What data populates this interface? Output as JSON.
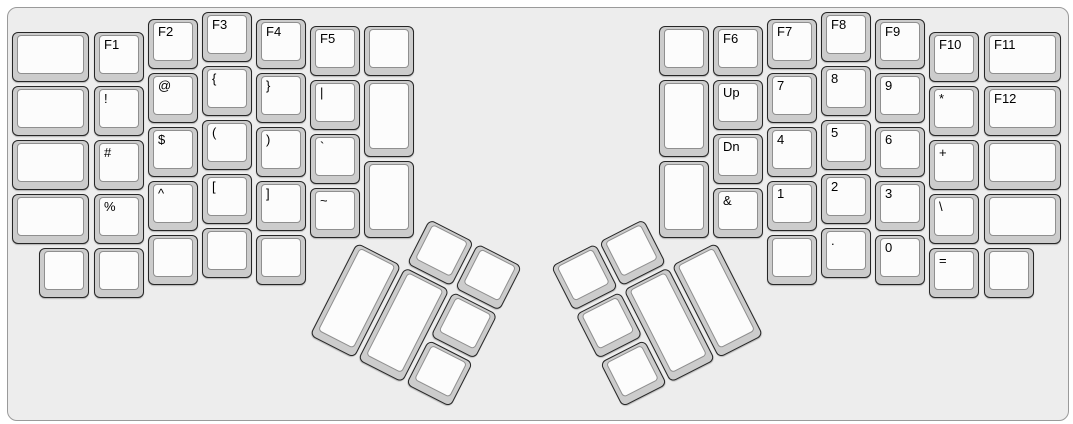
{
  "board": {
    "bg_color": "#ededed",
    "border_color": "#9a9a9a",
    "key_base_color": "#cccccc",
    "key_border_color": "#262626",
    "key_top_color": "#fcfcfc",
    "key_top_border_color": "#8f8f8f",
    "label_color": "#000000"
  },
  "unit_px": 54,
  "main_keys": [
    {
      "label": "",
      "x": 10,
      "y": 30,
      "w": 81,
      "h": 54
    },
    {
      "label": "",
      "x": 10,
      "y": 84,
      "w": 81,
      "h": 54
    },
    {
      "label": "",
      "x": 10,
      "y": 138,
      "w": 81,
      "h": 54
    },
    {
      "label": "",
      "x": 10,
      "y": 192,
      "w": 81,
      "h": 54
    },
    {
      "label": "F1",
      "x": 92,
      "y": 30,
      "w": 54,
      "h": 54
    },
    {
      "label": "!",
      "x": 92,
      "y": 84,
      "w": 54,
      "h": 54
    },
    {
      "label": "#",
      "x": 92,
      "y": 138,
      "w": 54,
      "h": 54
    },
    {
      "label": "%",
      "x": 92,
      "y": 192,
      "w": 54,
      "h": 54
    },
    {
      "label": "F2",
      "x": 146,
      "y": 17,
      "w": 54,
      "h": 54
    },
    {
      "label": "@",
      "x": 146,
      "y": 71,
      "w": 54,
      "h": 54
    },
    {
      "label": "$",
      "x": 146,
      "y": 125,
      "w": 54,
      "h": 54
    },
    {
      "label": "^",
      "x": 146,
      "y": 179,
      "w": 54,
      "h": 54
    },
    {
      "label": "F3",
      "x": 200,
      "y": 10,
      "w": 54,
      "h": 54
    },
    {
      "label": "{",
      "x": 200,
      "y": 64,
      "w": 54,
      "h": 54
    },
    {
      "label": "(",
      "x": 200,
      "y": 118,
      "w": 54,
      "h": 54
    },
    {
      "label": "[",
      "x": 200,
      "y": 172,
      "w": 54,
      "h": 54
    },
    {
      "label": "F4",
      "x": 254,
      "y": 17,
      "w": 54,
      "h": 54
    },
    {
      "label": "}",
      "x": 254,
      "y": 71,
      "w": 54,
      "h": 54
    },
    {
      "label": ")",
      "x": 254,
      "y": 125,
      "w": 54,
      "h": 54
    },
    {
      "label": "]",
      "x": 254,
      "y": 179,
      "w": 54,
      "h": 54
    },
    {
      "label": "F5",
      "x": 308,
      "y": 24,
      "w": 54,
      "h": 54
    },
    {
      "label": "|",
      "x": 308,
      "y": 78,
      "w": 54,
      "h": 54
    },
    {
      "label": "`",
      "x": 308,
      "y": 132,
      "w": 54,
      "h": 54
    },
    {
      "label": "~",
      "x": 308,
      "y": 186,
      "w": 54,
      "h": 54
    },
    {
      "label": "",
      "x": 362,
      "y": 24,
      "w": 54,
      "h": 54
    },
    {
      "label": "",
      "x": 362,
      "y": 78,
      "w": 54,
      "h": 81
    },
    {
      "label": "",
      "x": 362,
      "y": 159,
      "w": 54,
      "h": 81
    },
    {
      "label": "",
      "x": 37,
      "y": 246,
      "w": 54,
      "h": 54
    },
    {
      "label": "",
      "x": 92,
      "y": 246,
      "w": 54,
      "h": 54
    },
    {
      "label": "",
      "x": 146,
      "y": 233,
      "w": 54,
      "h": 54
    },
    {
      "label": "",
      "x": 200,
      "y": 226,
      "w": 54,
      "h": 54
    },
    {
      "label": "",
      "x": 254,
      "y": 233,
      "w": 54,
      "h": 54
    },
    {
      "label": "",
      "x": 657,
      "y": 24,
      "w": 54,
      "h": 54
    },
    {
      "label": "",
      "x": 657,
      "y": 78,
      "w": 54,
      "h": 81
    },
    {
      "label": "",
      "x": 657,
      "y": 159,
      "w": 54,
      "h": 81
    },
    {
      "label": "F6",
      "x": 711,
      "y": 24,
      "w": 54,
      "h": 54
    },
    {
      "label": "Up",
      "x": 711,
      "y": 78,
      "w": 54,
      "h": 54
    },
    {
      "label": "Dn",
      "x": 711,
      "y": 132,
      "w": 54,
      "h": 54
    },
    {
      "label": "&",
      "x": 711,
      "y": 186,
      "w": 54,
      "h": 54
    },
    {
      "label": "F7",
      "x": 765,
      "y": 17,
      "w": 54,
      "h": 54
    },
    {
      "label": "7",
      "x": 765,
      "y": 71,
      "w": 54,
      "h": 54
    },
    {
      "label": "4",
      "x": 765,
      "y": 125,
      "w": 54,
      "h": 54
    },
    {
      "label": "1",
      "x": 765,
      "y": 179,
      "w": 54,
      "h": 54
    },
    {
      "label": "F8",
      "x": 819,
      "y": 10,
      "w": 54,
      "h": 54
    },
    {
      "label": "8",
      "x": 819,
      "y": 64,
      "w": 54,
      "h": 54
    },
    {
      "label": "5",
      "x": 819,
      "y": 118,
      "w": 54,
      "h": 54
    },
    {
      "label": "2",
      "x": 819,
      "y": 172,
      "w": 54,
      "h": 54
    },
    {
      "label": "F9",
      "x": 873,
      "y": 17,
      "w": 54,
      "h": 54
    },
    {
      "label": "9",
      "x": 873,
      "y": 71,
      "w": 54,
      "h": 54
    },
    {
      "label": "6",
      "x": 873,
      "y": 125,
      "w": 54,
      "h": 54
    },
    {
      "label": "3",
      "x": 873,
      "y": 179,
      "w": 54,
      "h": 54
    },
    {
      "label": "F10",
      "x": 927,
      "y": 30,
      "w": 54,
      "h": 54
    },
    {
      "label": "*",
      "x": 927,
      "y": 84,
      "w": 54,
      "h": 54
    },
    {
      "label": "+",
      "x": 927,
      "y": 138,
      "w": 54,
      "h": 54
    },
    {
      "label": "\\",
      "x": 927,
      "y": 192,
      "w": 54,
      "h": 54
    },
    {
      "label": "F11",
      "x": 982,
      "y": 30,
      "w": 81,
      "h": 54
    },
    {
      "label": "F12",
      "x": 982,
      "y": 84,
      "w": 81,
      "h": 54
    },
    {
      "label": "",
      "x": 982,
      "y": 138,
      "w": 81,
      "h": 54
    },
    {
      "label": "",
      "x": 982,
      "y": 192,
      "w": 81,
      "h": 54
    },
    {
      "label": "",
      "x": 765,
      "y": 233,
      "w": 54,
      "h": 54
    },
    {
      "label": ".",
      "x": 819,
      "y": 226,
      "w": 54,
      "h": 54
    },
    {
      "label": "0",
      "x": 873,
      "y": 233,
      "w": 54,
      "h": 54
    },
    {
      "label": "=",
      "x": 927,
      "y": 246,
      "w": 54,
      "h": 54
    },
    {
      "label": "",
      "x": 982,
      "y": 246,
      "w": 54,
      "h": 54
    }
  ],
  "thumb_clusters": [
    {
      "name": "left-thumb-cluster",
      "origin_x": 356,
      "origin_y": 240,
      "angle_deg": 27,
      "keys": [
        {
          "label": "",
          "x": 54,
          "y": -54,
          "w": 54,
          "h": 54
        },
        {
          "label": "",
          "x": 108,
          "y": -54,
          "w": 54,
          "h": 54
        },
        {
          "label": "",
          "x": 0,
          "y": 0,
          "w": 54,
          "h": 108
        },
        {
          "label": "",
          "x": 54,
          "y": 0,
          "w": 54,
          "h": 108
        },
        {
          "label": "",
          "x": 108,
          "y": 0,
          "w": 54,
          "h": 54
        },
        {
          "label": "",
          "x": 108,
          "y": 54,
          "w": 54,
          "h": 54
        }
      ]
    },
    {
      "name": "right-thumb-cluster",
      "origin_x": 717,
      "origin_y": 240,
      "angle_deg": -27,
      "keys": [
        {
          "label": "",
          "x": -108,
          "y": -54,
          "w": 54,
          "h": 54
        },
        {
          "label": "",
          "x": -162,
          "y": -54,
          "w": 54,
          "h": 54
        },
        {
          "label": "",
          "x": -54,
          "y": 0,
          "w": 54,
          "h": 108
        },
        {
          "label": "",
          "x": -108,
          "y": 0,
          "w": 54,
          "h": 108
        },
        {
          "label": "",
          "x": -162,
          "y": 0,
          "w": 54,
          "h": 54
        },
        {
          "label": "",
          "x": -162,
          "y": 54,
          "w": 54,
          "h": 54
        }
      ]
    }
  ]
}
